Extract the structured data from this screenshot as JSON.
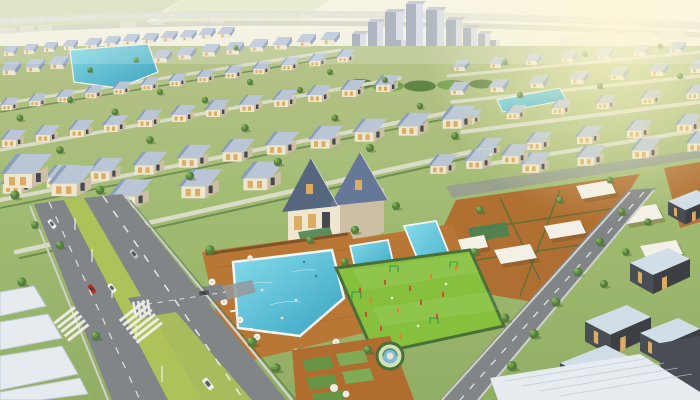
{
  "scene": {
    "description": "Sunny aerial 3D rendering of a master-planned suburban neighborhood: diagonal rows of blue-roofed cream houses, a community pool complex with wooden decks and white umbrellas, a bright green playground with children, tree-lined roads with cars and crosswalks, terracotta courtyards under white canopies, modern flat-roof homes, warehouses, and a cluster of high-rise towers on the hazy horizon.",
    "time_of_day": "bright daylight",
    "elements": {
      "high_rise_towers": 10,
      "house_rows": "multiple diagonal rows of detached gable and hip-roof homes",
      "pools": [
        "L-shaped community pool",
        "small leisure pool",
        "lap pool",
        "lagoon pond",
        "canal"
      ],
      "playground": {
        "figures": 13,
        "goal_frames": 4,
        "circular_feature": 1
      },
      "cars": [
        "white",
        "silver",
        "red",
        "white",
        "dark-gray",
        "white van"
      ],
      "crosswalks": 3,
      "umbrellas": 8,
      "warehouses": 5
    }
  },
  "palette": {
    "sky_top": "#f7f4e3",
    "sky_horizon": "#eef0da",
    "far_field": "#ccd9ab",
    "highway": "#dfe0d2",
    "distant_building": "#e9e7da",
    "tower_face": "#98a3b2",
    "tower_lit": "#d3dae2",
    "tower_top": "#b9c2cd",
    "grass_top": "#b3c186",
    "grass_mid": "#9cb96c",
    "grass_low": "#8cab5d",
    "lawn_playground": "#7fbe33",
    "tree_dark": "#4a7533",
    "tree_mid": "#649840",
    "tree_light": "#83b25a",
    "hedge": "#3d6930",
    "roof_light": "#b6c4d6",
    "roof_mid": "#8499b8",
    "roof_dark": "#5d7194",
    "roof_charcoal": "#4d5e7a",
    "wall_cream": "#efe6cf",
    "wall_shade": "#c9bda2",
    "wall_dark": "#433f38",
    "window_amber": "#d9a85a",
    "window_dark": "#3a3f46",
    "water_light": "#7edced",
    "water_deep": "#2d9fc0",
    "pool_coping": "#f2f6f6",
    "deck_wood": "#b5702c",
    "deck_shadow": "#8f5420",
    "road": "#7b7f82",
    "road_light": "#8f9396",
    "marking": "#f2f2ee",
    "median": "#a8c050",
    "canopy": "#f3f1e8",
    "courtyard": "#ad6425",
    "modern_roof": "#cfdce8",
    "modern_wall": "#3d444c",
    "modern_wall_dark": "#30363c",
    "warehouse_roof": "#e4ebf1",
    "warehouse_edge": "#b9c6d2",
    "car_red": "#c22318",
    "car_white": "#f4f4f2",
    "car_silver": "#b9bcbe",
    "car_dark": "#4a4e52",
    "figure_red": "#c23a28",
    "figure_orange": "#e07b28",
    "sun_glow": "#fff8cc"
  }
}
